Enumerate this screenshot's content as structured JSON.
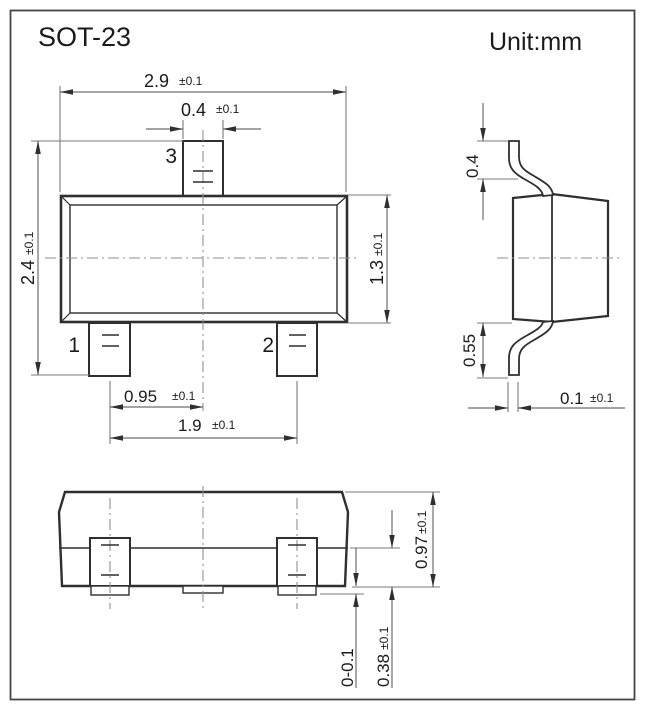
{
  "title": "SOT-23",
  "unit_label": "Unit:mm",
  "colors": {
    "object_line": "#2f2f2f",
    "dimension_line": "#6e6e6e",
    "centerline": "#8f8f8f",
    "text": "#1b1b1d",
    "background": "#ffffff"
  },
  "pins": {
    "p1": "1",
    "p2": "2",
    "p3": "3"
  },
  "dims": {
    "body_width": {
      "v": "2.9",
      "t": "±0.1"
    },
    "lead_width_top": {
      "v": "0.4",
      "t": "±0.1"
    },
    "overall_height": {
      "v": "2.4",
      "t": "±0.1"
    },
    "body_height": {
      "v": "1.3",
      "t": "±0.1"
    },
    "pin_center": {
      "v": "0.95",
      "t": "±0.1"
    },
    "pin_pitch": {
      "v": "1.9",
      "t": "±0.1"
    },
    "lead_rise": {
      "v": "0.4",
      "t": ""
    },
    "lead_drop": {
      "v": "0.55",
      "t": ""
    },
    "lead_thickness": {
      "v": "0.1",
      "t": "±0.1"
    },
    "pkg_thickness": {
      "v": "0.97",
      "t": "±0.1"
    },
    "standoff": {
      "v": "0-0.1",
      "t": ""
    },
    "lead_width_front": {
      "v": "0.38",
      "t": "±0.1"
    }
  }
}
